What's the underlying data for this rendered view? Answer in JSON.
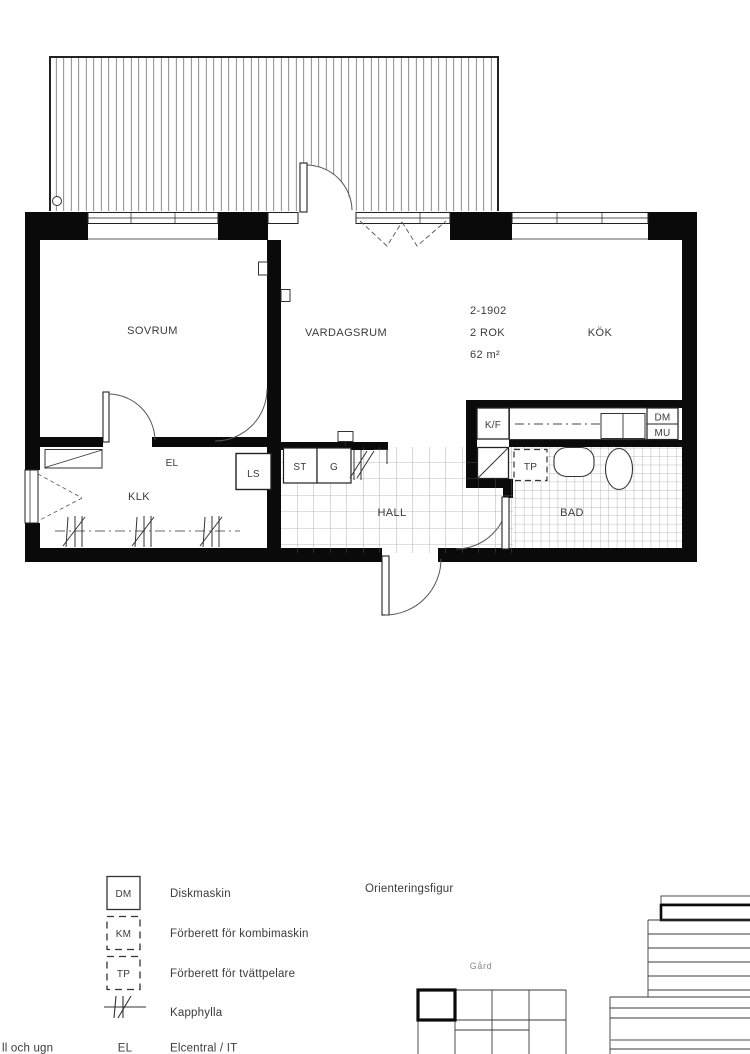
{
  "plan": {
    "unit": {
      "id": "2-1902",
      "rooms": "2 ROK",
      "area": "62 m²"
    },
    "labels": {
      "sovrum": "SOVRUM",
      "vardagsrum": "VARDAGSRUM",
      "kok": "KÖK",
      "klk": "KLK",
      "hall": "HALL",
      "bad": "BAD",
      "el": "EL",
      "ls": "LS",
      "st": "ST",
      "g": "G",
      "kf": "K/F",
      "dm": "DM",
      "mu": "MU",
      "tp": "TP"
    }
  },
  "legend": {
    "items": [
      {
        "symbol": "DM",
        "label": "Diskmaskin"
      },
      {
        "symbol": "KM",
        "label": "Förberett för kombimaskin"
      },
      {
        "symbol": "TP",
        "label": "Förberett för tvättpelare"
      },
      {
        "symbol": "",
        "label": "Kapphylla"
      },
      {
        "symbol": "EL",
        "label": "Elcentral / IT"
      }
    ],
    "cropped_text": "ll och ugn",
    "orientation_title": "Orienteringsfigur",
    "courtyard_label": "Gård"
  },
  "colors": {
    "wall": "#0a0a0a",
    "line": "#2a2a2a",
    "tile": "#7d7d7d",
    "text": "#3b3b3b"
  }
}
